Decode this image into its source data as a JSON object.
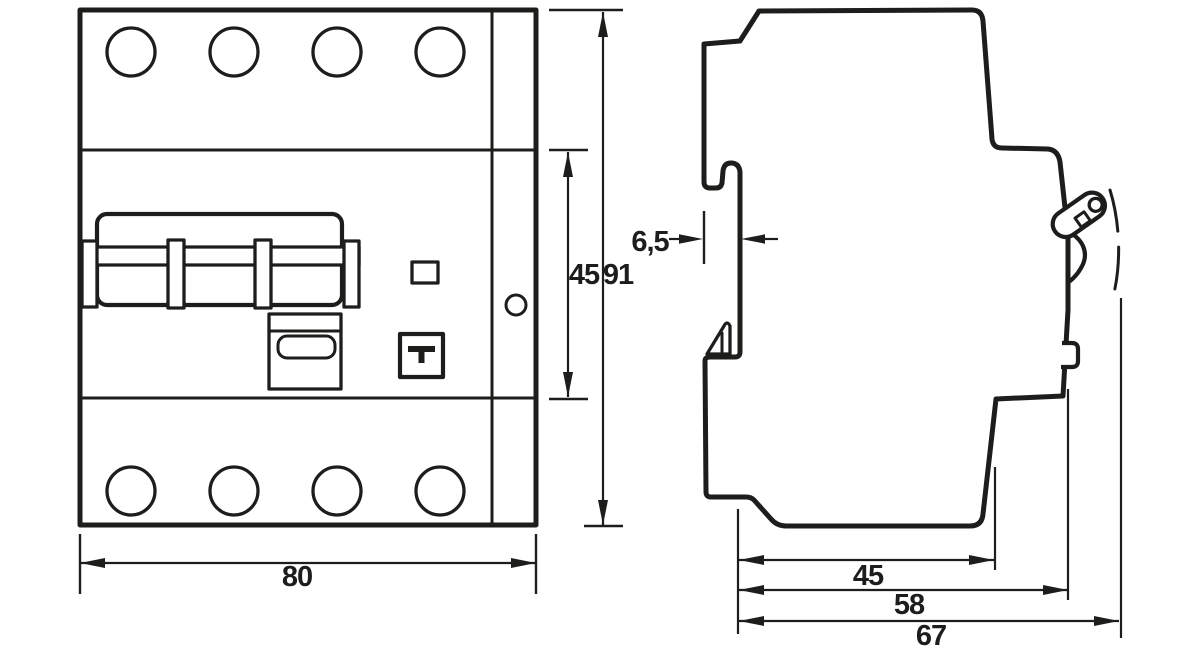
{
  "drawing": {
    "kind": "technical-dimension-drawing",
    "subject": "4-pole DIN-rail residual current circuit breaker",
    "views": [
      "front",
      "side"
    ],
    "line_color": "#1d1d1b",
    "background_color": "#ffffff"
  },
  "front_view": {
    "width_mm": "80",
    "height_mm": "91",
    "inner_height_mm": "45"
  },
  "side_view": {
    "rail_recess_mm": "6,5",
    "depth_to_step_mm": "45",
    "depth_body_mm": "58",
    "depth_overall_mm": "67"
  }
}
